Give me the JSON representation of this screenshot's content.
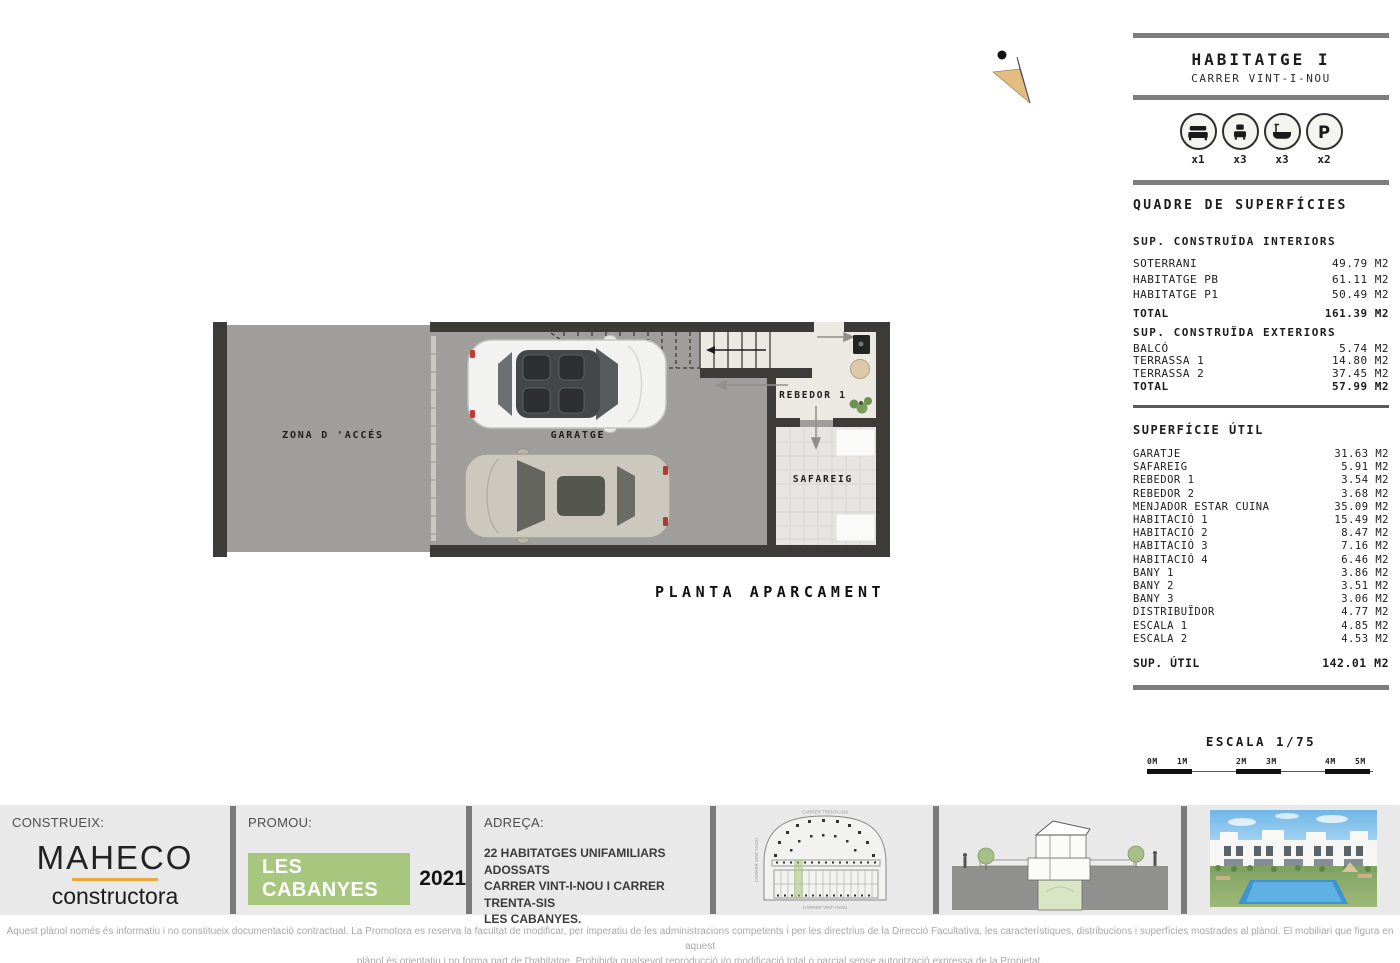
{
  "header": {
    "title": "HABITATGE I",
    "subtitle": "CARRER VINT-I-NOU"
  },
  "unit_icons": {
    "items": [
      {
        "icon": "double-bed",
        "count": "x1"
      },
      {
        "icon": "single-bed",
        "count": "x3"
      },
      {
        "icon": "bathtub",
        "count": "x3"
      },
      {
        "icon": "parking",
        "count": "x2"
      }
    ]
  },
  "surfaces": {
    "title": "QUADRE DE SUPERFÍCIES",
    "interiors": {
      "heading": "SUP. CONSTRUÏDA INTERIORS",
      "rows": [
        {
          "label": "SOTERRANI",
          "value": "49.79 M2"
        },
        {
          "label": "HABITATGE PB",
          "value": "61.11 M2"
        },
        {
          "label": "HABITATGE P1",
          "value": "50.49 M2"
        }
      ],
      "total": {
        "label": "TOTAL",
        "value": "161.39 M2"
      }
    },
    "exteriors": {
      "heading": "SUP. CONSTRUÏDA EXTERIORS",
      "rows": [
        {
          "label": "BALCÓ",
          "value": "5.74 M2"
        },
        {
          "label": "TERRASSA 1",
          "value": "14.80 M2"
        },
        {
          "label": "TERRASSA 2",
          "value": "37.45 M2"
        }
      ],
      "total": {
        "label": "TOTAL",
        "value": "57.99 M2"
      }
    },
    "useful": {
      "heading": "SUPERFÍCIE ÚTIL",
      "rows": [
        {
          "label": "GARATJE",
          "value": "31.63 M2"
        },
        {
          "label": "SAFAREIG",
          "value": "5.91 M2"
        },
        {
          "label": "REBEDOR 1",
          "value": "3.54 M2"
        },
        {
          "label": "REBEDOR 2",
          "value": "3.68 M2"
        },
        {
          "label": "MENJADOR ESTAR CUINA",
          "value": "35.09 M2"
        },
        {
          "label": "HABITACIÓ 1",
          "value": "15.49 M2"
        },
        {
          "label": "HABITACIÓ 2",
          "value": "8.47 M2"
        },
        {
          "label": "HABITACIÓ 3",
          "value": "7.16 M2"
        },
        {
          "label": "HABITACIÓ 4",
          "value": "6.46 M2"
        },
        {
          "label": "BANY 1",
          "value": "3.86 M2"
        },
        {
          "label": "BANY 2",
          "value": "3.51 M2"
        },
        {
          "label": "BANY 3",
          "value": "3.06 M2"
        },
        {
          "label": "DISTRIBUÏDOR",
          "value": "4.77 M2"
        },
        {
          "label": "ESCALA 1",
          "value": "4.85 M2"
        },
        {
          "label": "ESCALA 2",
          "value": "4.53 M2"
        }
      ],
      "total": {
        "label": "SUP. ÚTIL",
        "value": "142.01 M2"
      }
    }
  },
  "plan": {
    "title": "PLANTA APARCAMENT",
    "rooms": {
      "zona": "ZONA D 'ACCÉS",
      "garatge": "GARATGE",
      "rebedor": "REBEDOR 1",
      "safareig": "SAFAREIG"
    }
  },
  "scale": {
    "title": "ESCALA 1/75",
    "ticks": [
      "0M",
      "1M",
      "2M",
      "3M",
      "4M",
      "5M"
    ]
  },
  "bottom_bar": {
    "builder": {
      "label": "CONSTRUEIX:",
      "brand": "MAHECO",
      "brand_sub": "constructora"
    },
    "promoter": {
      "label": "PROMOU:",
      "name": "LES CABANYES",
      "year": "2021"
    },
    "address": {
      "label": "ADREÇA:",
      "lines": [
        "22 HABITATGES UNIFAMILIARS ADOSSATS",
        "CARRER VINT-I-NOU I CARRER TRENTA-SIS",
        "LES CABANYES."
      ]
    },
    "siteplan": {
      "street_top": "CARRER TRENTA-SIS",
      "street_left": "CARRER VINT-I-NOU",
      "street_bottom": "CARRER VINT-I-NOU"
    }
  },
  "disclaimer": {
    "line1": "Aquest plànol només és informatiu i no constitueix documentació contractual. La Promotora es reserva la facultat de modificar, per imperatiu de les administracions competents i per les directrius de la Direcció Facultativa, les característiques, distribucions i superfícies mostrades al plànol. El mobiliari que figura en aquest",
    "line2": "plànol és orientatiu i no forma part de l'habitatge. Prohibida qualsevol reproducció i/o modificació total o parcial sense autorització expressa de la Propietat."
  },
  "colors": {
    "accent_green": "#a8c77e",
    "accent_orange": "#e8a93e",
    "wall": "#3d3b38",
    "floor_gray": "#9f9e9c",
    "bar_gray": "#7d7d7d"
  }
}
